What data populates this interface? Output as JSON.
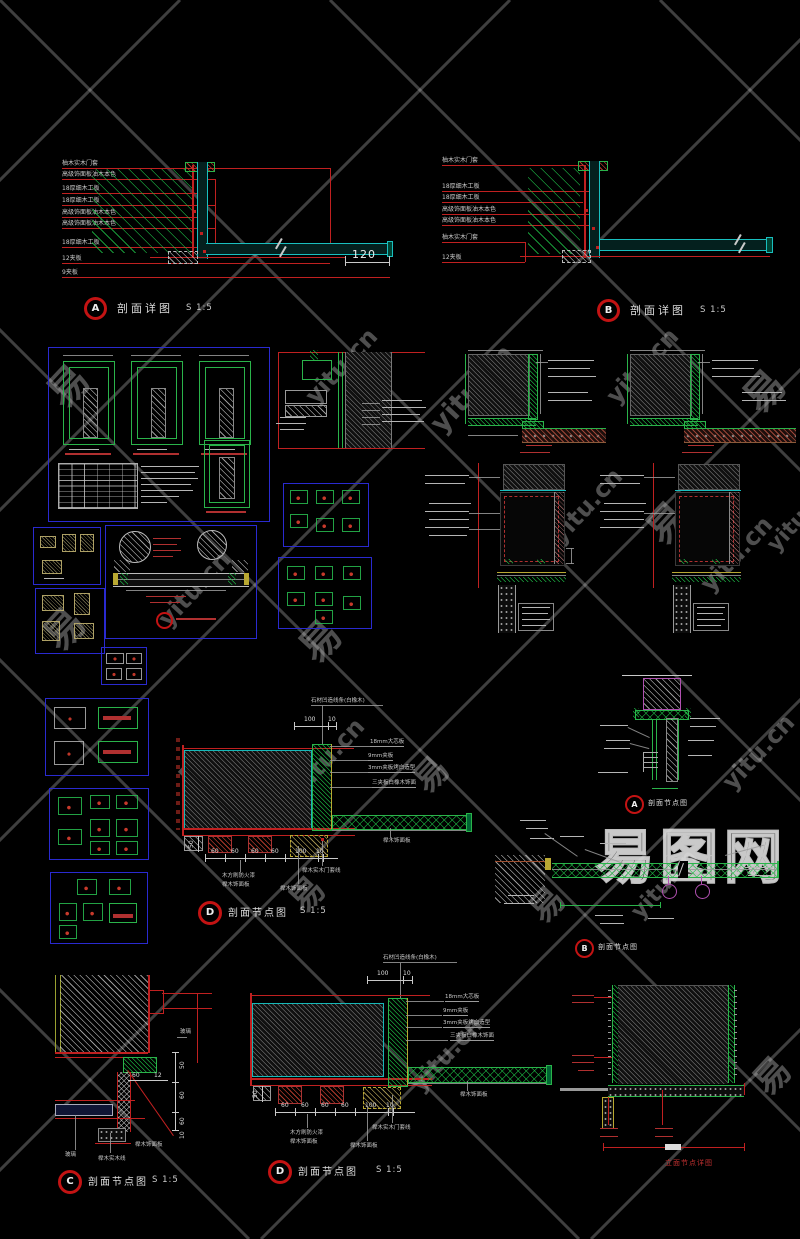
{
  "watermark": {
    "char": "易",
    "site": "yitu.cn",
    "logo": "易图网"
  },
  "captions": {
    "a_top": {
      "letter": "A",
      "title": "剖面详图",
      "scale": "S 1:5"
    },
    "b_top": {
      "letter": "B",
      "title": "剖面详图",
      "scale": "S 1:5"
    },
    "d_mid": {
      "letter": "D",
      "title": "剖面节点图",
      "scale": "S 1:5"
    },
    "a_node": {
      "letter": "A",
      "title": "剖面节点图"
    },
    "b_node": {
      "letter": "B",
      "title": "剖面节点图"
    },
    "c_node": {
      "letter": "C",
      "title": "剖面节点图",
      "scale": "S 1:5"
    },
    "d_bot": {
      "letter": "D",
      "title": "剖面节点图",
      "scale": "S 1:5"
    },
    "elev": {
      "title": "立面节点详图"
    }
  },
  "detail_a": {
    "labels": [
      "柚木实木门套",
      "高级饰面板油木本色",
      "18厚细木工板",
      "18厚细木工板",
      "高级饰面板油木本色",
      "高级饰面板油木本色",
      "18厚细木工板",
      "12夹板",
      "9夹板"
    ],
    "dim": "120"
  },
  "detail_b": {
    "labels": [
      "柚木实木门套",
      "18厚细木工板",
      "18厚细木工板",
      "高级饰面板油木本色",
      "高级饰面板油木本色",
      "柚木实木门套",
      "12夹板"
    ]
  },
  "node_d": {
    "top_label": "石材凹造线条(白橡木)",
    "right_labels": [
      "18mm大芯板",
      "9mm夹板",
      "3mm夹板烤白造型",
      "三夹板白橡木饰面",
      "榉木饰面板"
    ],
    "bottom_labels": [
      "木方刷防火漆",
      "榉木饰面板",
      "榉木饰面板",
      "榉木实木门套线"
    ],
    "dims_top": [
      "100",
      "10"
    ],
    "dims_bottom": [
      "60",
      "60",
      "60",
      "60",
      "100",
      "10"
    ],
    "dim_left": "50"
  },
  "node_c": {
    "label_right": "玻璃",
    "label_mid": "榉木饰面板",
    "label_b1": "玻璃",
    "label_b2": "榉木实木线",
    "dims_right": [
      "50",
      "60",
      "60",
      "10"
    ],
    "dims_top": [
      "60",
      "12"
    ]
  }
}
